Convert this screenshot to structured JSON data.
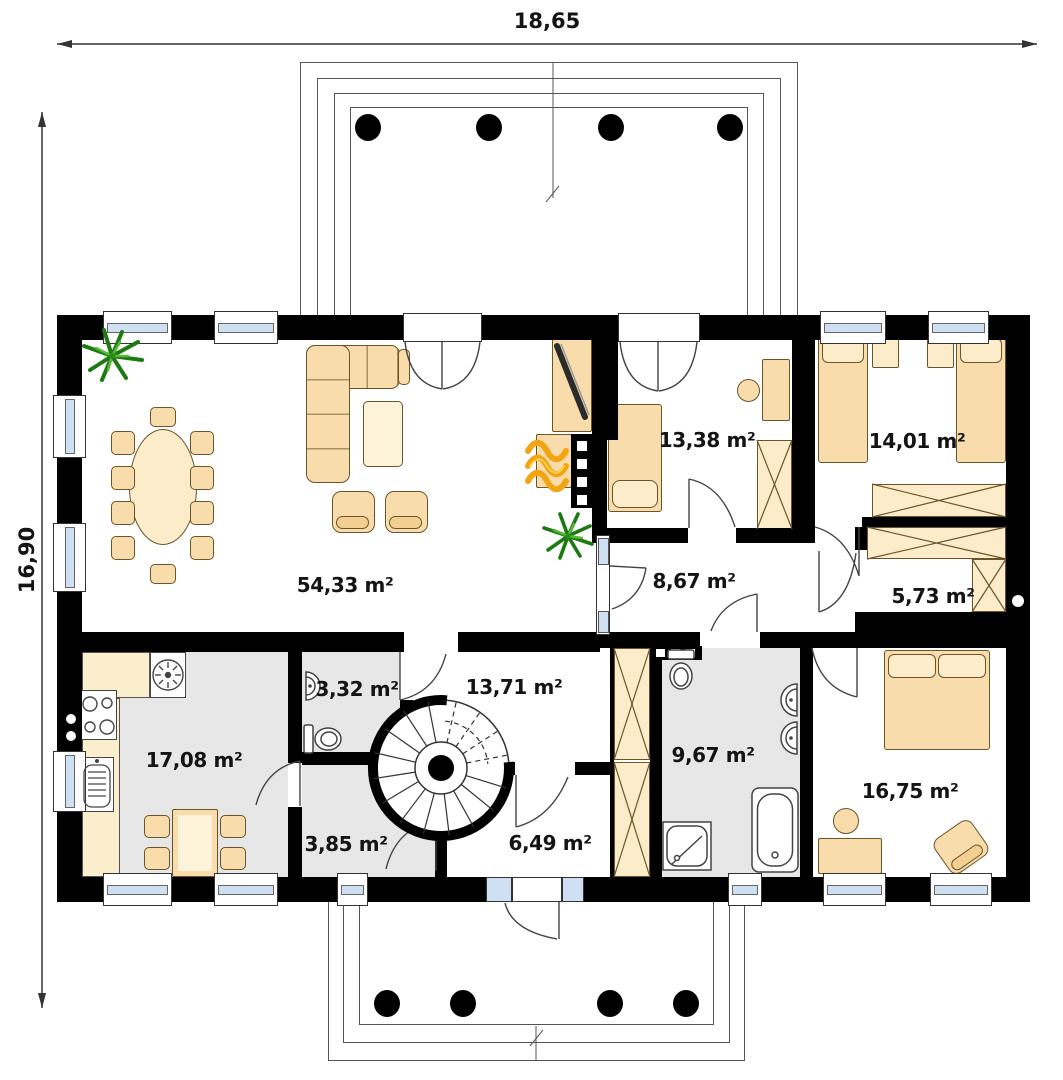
{
  "dimensions": {
    "width": "18,65",
    "height": "16,90"
  },
  "rooms": {
    "living": {
      "area": "54,33 m²"
    },
    "bedroom1": {
      "area": "13,38 m²"
    },
    "bedroom2": {
      "area": "14,01 m²"
    },
    "hallway": {
      "area": "8,67 m²"
    },
    "closet": {
      "area": "5,73 m²"
    },
    "kitchen": {
      "area": "17,08 m²"
    },
    "wc": {
      "area": "3,32 m²"
    },
    "stair_hall": {
      "area": "13,71 m²"
    },
    "corridor": {
      "area": "3,85 m²"
    },
    "vestibule": {
      "area": "6,49 m²"
    },
    "bathroom": {
      "area": "9,67 m²"
    },
    "master_bedroom": {
      "area": "16,75 m²"
    }
  },
  "colors": {
    "wall": "#000000",
    "floor": "#ffffff",
    "floor_secondary": "#e7e7e7",
    "furniture": "#f8dcab",
    "furniture_light": "#fcecca",
    "window_glass": "#cfe0f2",
    "plant": "#1d7a12",
    "flame": "#f1a512"
  }
}
